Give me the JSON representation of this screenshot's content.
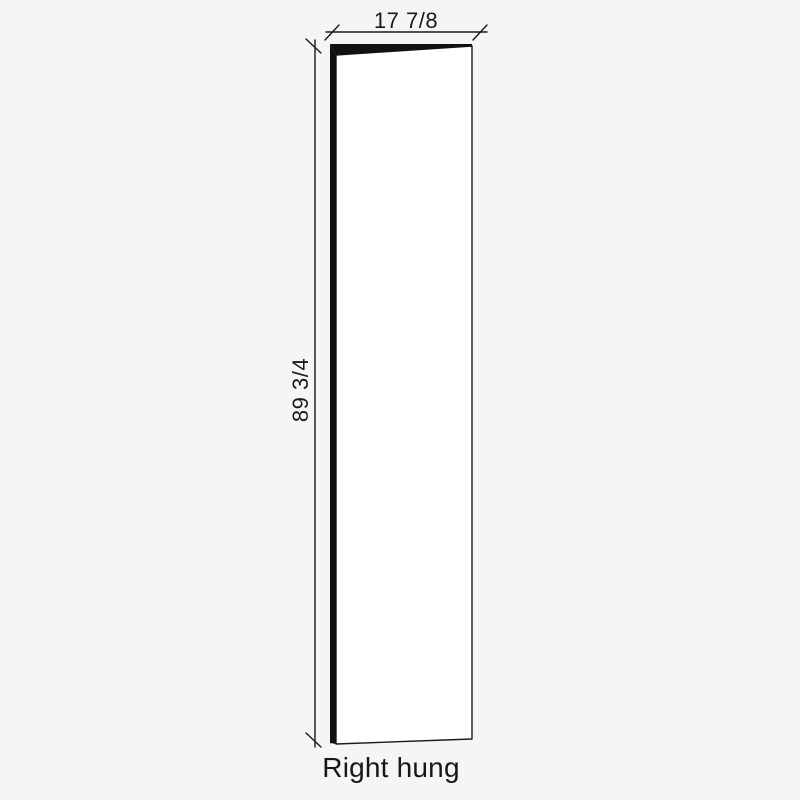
{
  "diagram": {
    "type": "door-dimension-diagram",
    "caption": "Right hung",
    "width_dimension": {
      "label": "17 7/8",
      "unit": "inches"
    },
    "height_dimension": {
      "label": "89 3/4",
      "unit": "inches"
    },
    "colors": {
      "background": "#f5f5f5",
      "door_face": "#ffffff",
      "door_edge": "#111111",
      "line": "#1a1a1a",
      "text": "#171717"
    }
  }
}
